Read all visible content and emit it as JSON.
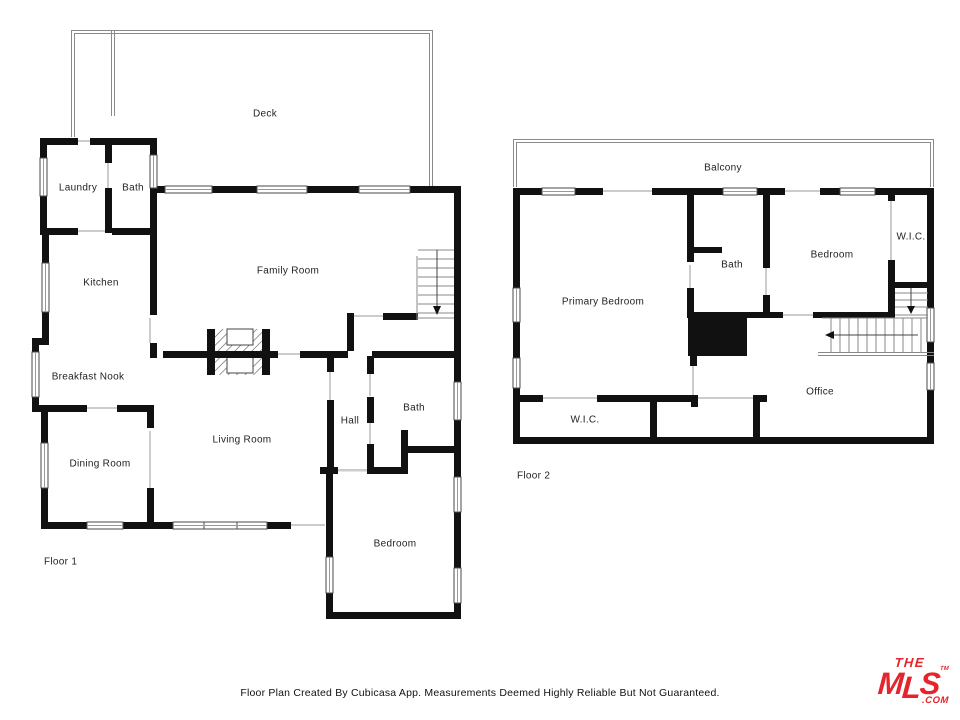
{
  "floor1": {
    "label": "Floor 1",
    "rooms": {
      "deck": "Deck",
      "laundry": "Laundry",
      "bath_upper": "Bath",
      "kitchen": "Kitchen",
      "family_room": "Family Room",
      "breakfast_nook": "Breakfast Nook",
      "dining_room": "Dining Room",
      "living_room": "Living Room",
      "hall": "Hall",
      "bath_lower": "Bath",
      "bedroom": "Bedroom"
    }
  },
  "floor2": {
    "label": "Floor 2",
    "rooms": {
      "balcony": "Balcony",
      "primary_bedroom": "Primary Bedroom",
      "bath": "Bath",
      "bedroom": "Bedroom",
      "wic_upper": "W.I.C.",
      "wic_lower": "W.I.C.",
      "office": "Office"
    }
  },
  "footer": {
    "disclaimer": "Floor Plan Created By Cubicasa App. Measurements Deemed Highly Reliable But Not Guaranteed."
  },
  "logo": {
    "the": "THE",
    "m": "M",
    "l": "L",
    "s": "S",
    "com": ".COM",
    "tm": "TM",
    "color": "#e4252b"
  },
  "colors": {
    "wall": "#111111",
    "railing": "#8a8a8a",
    "door_opening": "#cccccc"
  }
}
